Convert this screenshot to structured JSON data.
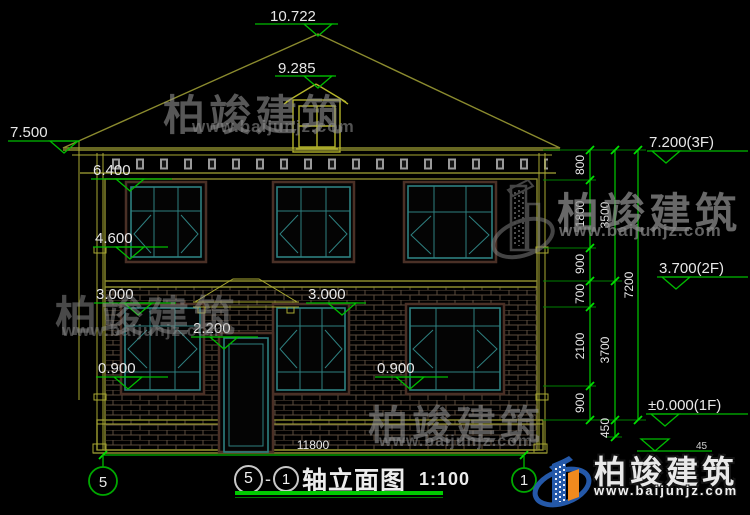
{
  "drawing_type": "architectural-elevation",
  "dims": {
    "top": [
      "10.722",
      "9.285"
    ],
    "left": [
      "7.500",
      "6.400",
      "4.600",
      "3.000",
      "2.200",
      "0.900"
    ],
    "mid": [
      "3.000",
      "0.900"
    ],
    "right_levels": [
      "7.200(3F)",
      "3.700(2F)",
      "±0.000(1F)"
    ],
    "ground_fragment": "45",
    "chain_inner": [
      "800",
      "1800",
      "900",
      "700",
      "2100",
      "900"
    ],
    "chain_mid": [
      "3500",
      "3700",
      "450"
    ],
    "chain_outer": [
      "7200"
    ],
    "width_total": "11800"
  },
  "axes": {
    "left": "5",
    "right": "1"
  },
  "title": {
    "bubble_left": "5",
    "separator": "-",
    "bubble_right": "1",
    "text": "轴立面图",
    "scale": "1:100"
  },
  "brand": {
    "name": "柏竣建筑",
    "site": "www.baijunjz.com"
  },
  "colors": {
    "background": "#000000",
    "dimension_green": "#00bb00",
    "tick_green": "#00e000",
    "outline_olive": "#8b8b2e",
    "window_teal": "#2e8080",
    "window_trim": "#4a3026",
    "brick_line": "#5b4c3d",
    "dim_text": "#e8e8e8",
    "logo_blue": "#2458a8",
    "logo_orange": "#f08a1e"
  }
}
